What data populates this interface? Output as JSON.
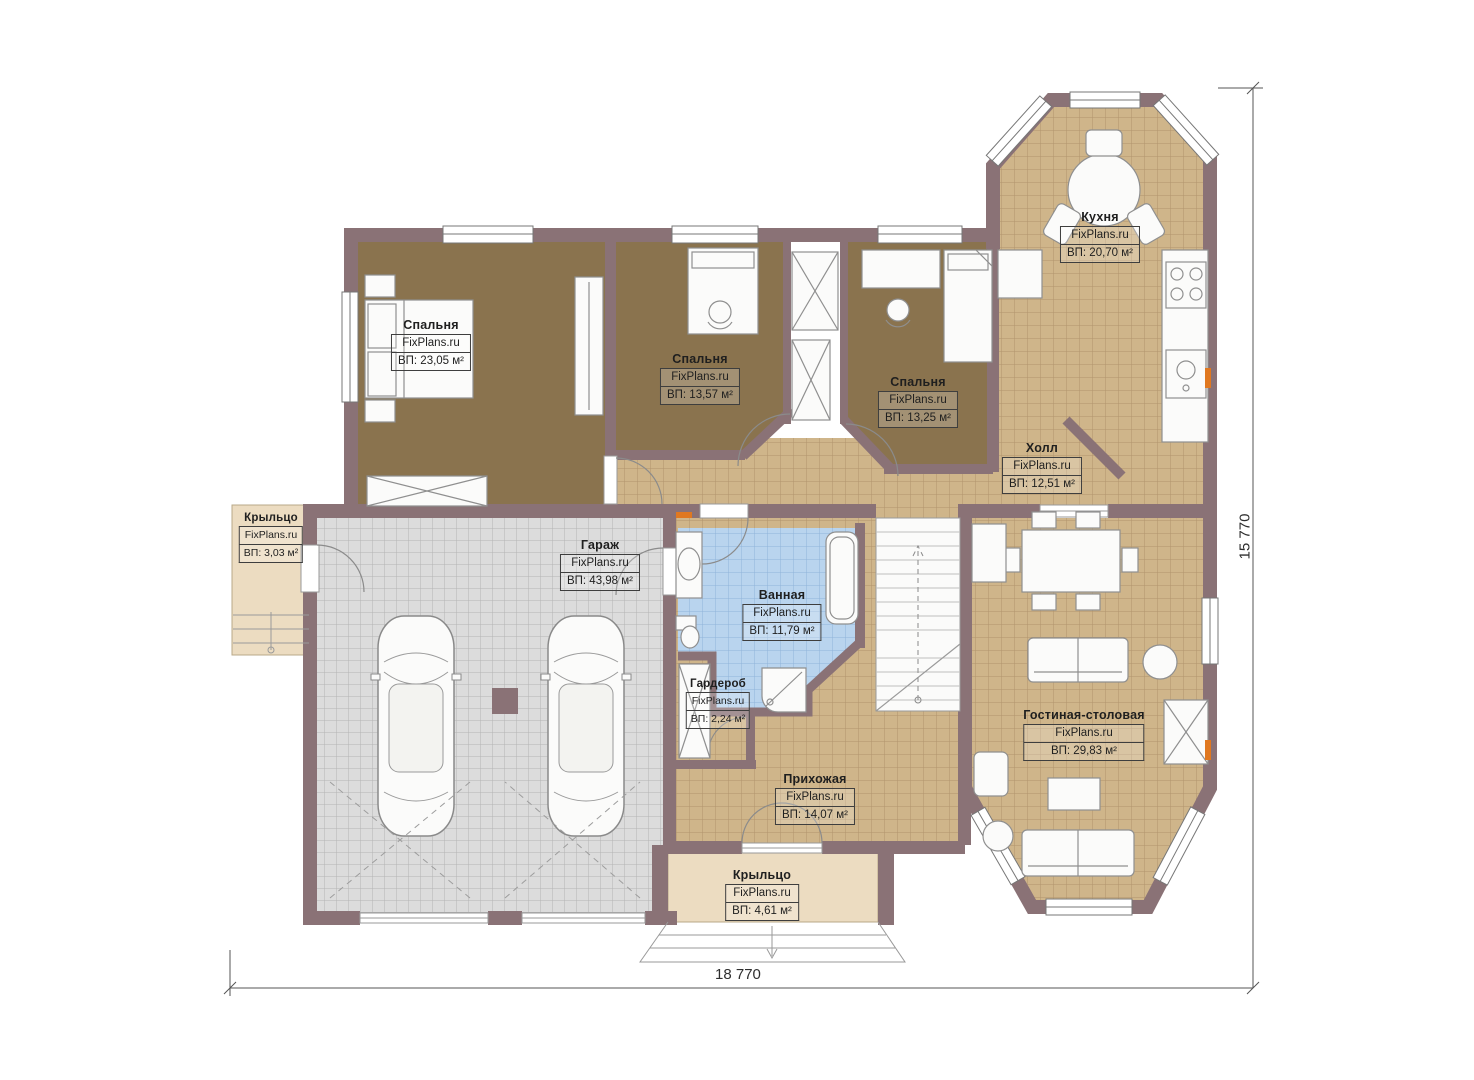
{
  "plan": {
    "watermark": "FixPlans.ru",
    "rooms": {
      "bedroom1": {
        "name": "Спальня",
        "area": "ВП: 23,05 м²"
      },
      "bedroom2": {
        "name": "Спальня",
        "area": "ВП: 13,57 м²"
      },
      "bedroom3": {
        "name": "Спальня",
        "area": "ВП: 13,25 м²"
      },
      "kitchen": {
        "name": "Кухня",
        "area": "ВП: 20,70 м²"
      },
      "hall": {
        "name": "Холл",
        "area": "ВП: 12,51 м²"
      },
      "porch_left": {
        "name": "Крыльцо",
        "area": "ВП: 3,03 м²"
      },
      "garage": {
        "name": "Гараж",
        "area": "ВП: 43,98 м²"
      },
      "bathroom": {
        "name": "Ванная",
        "area": "ВП: 11,79 м²"
      },
      "wardrobe": {
        "name": "Гардероб",
        "area": "ВП: 2,24 м²"
      },
      "entry": {
        "name": "Прихожая",
        "area": "ВП: 14,07 м²"
      },
      "living": {
        "name": "Гостиная-столовая",
        "area": "ВП: 29,83 м²"
      },
      "porch_front": {
        "name": "Крыльцо",
        "area": "ВП: 4,61 м²"
      }
    },
    "dimensions": {
      "width": "18 770",
      "height": "15 770"
    },
    "colors": {
      "wall": "#8a7276",
      "bedroom_floor": "#8a734e",
      "tile_floor": "#cfb58a",
      "garage_floor": "#dcdcdc",
      "bath_floor": "#b9d4ee",
      "porch_floor": "#ecdcc1",
      "radiator": "#e07820"
    }
  }
}
